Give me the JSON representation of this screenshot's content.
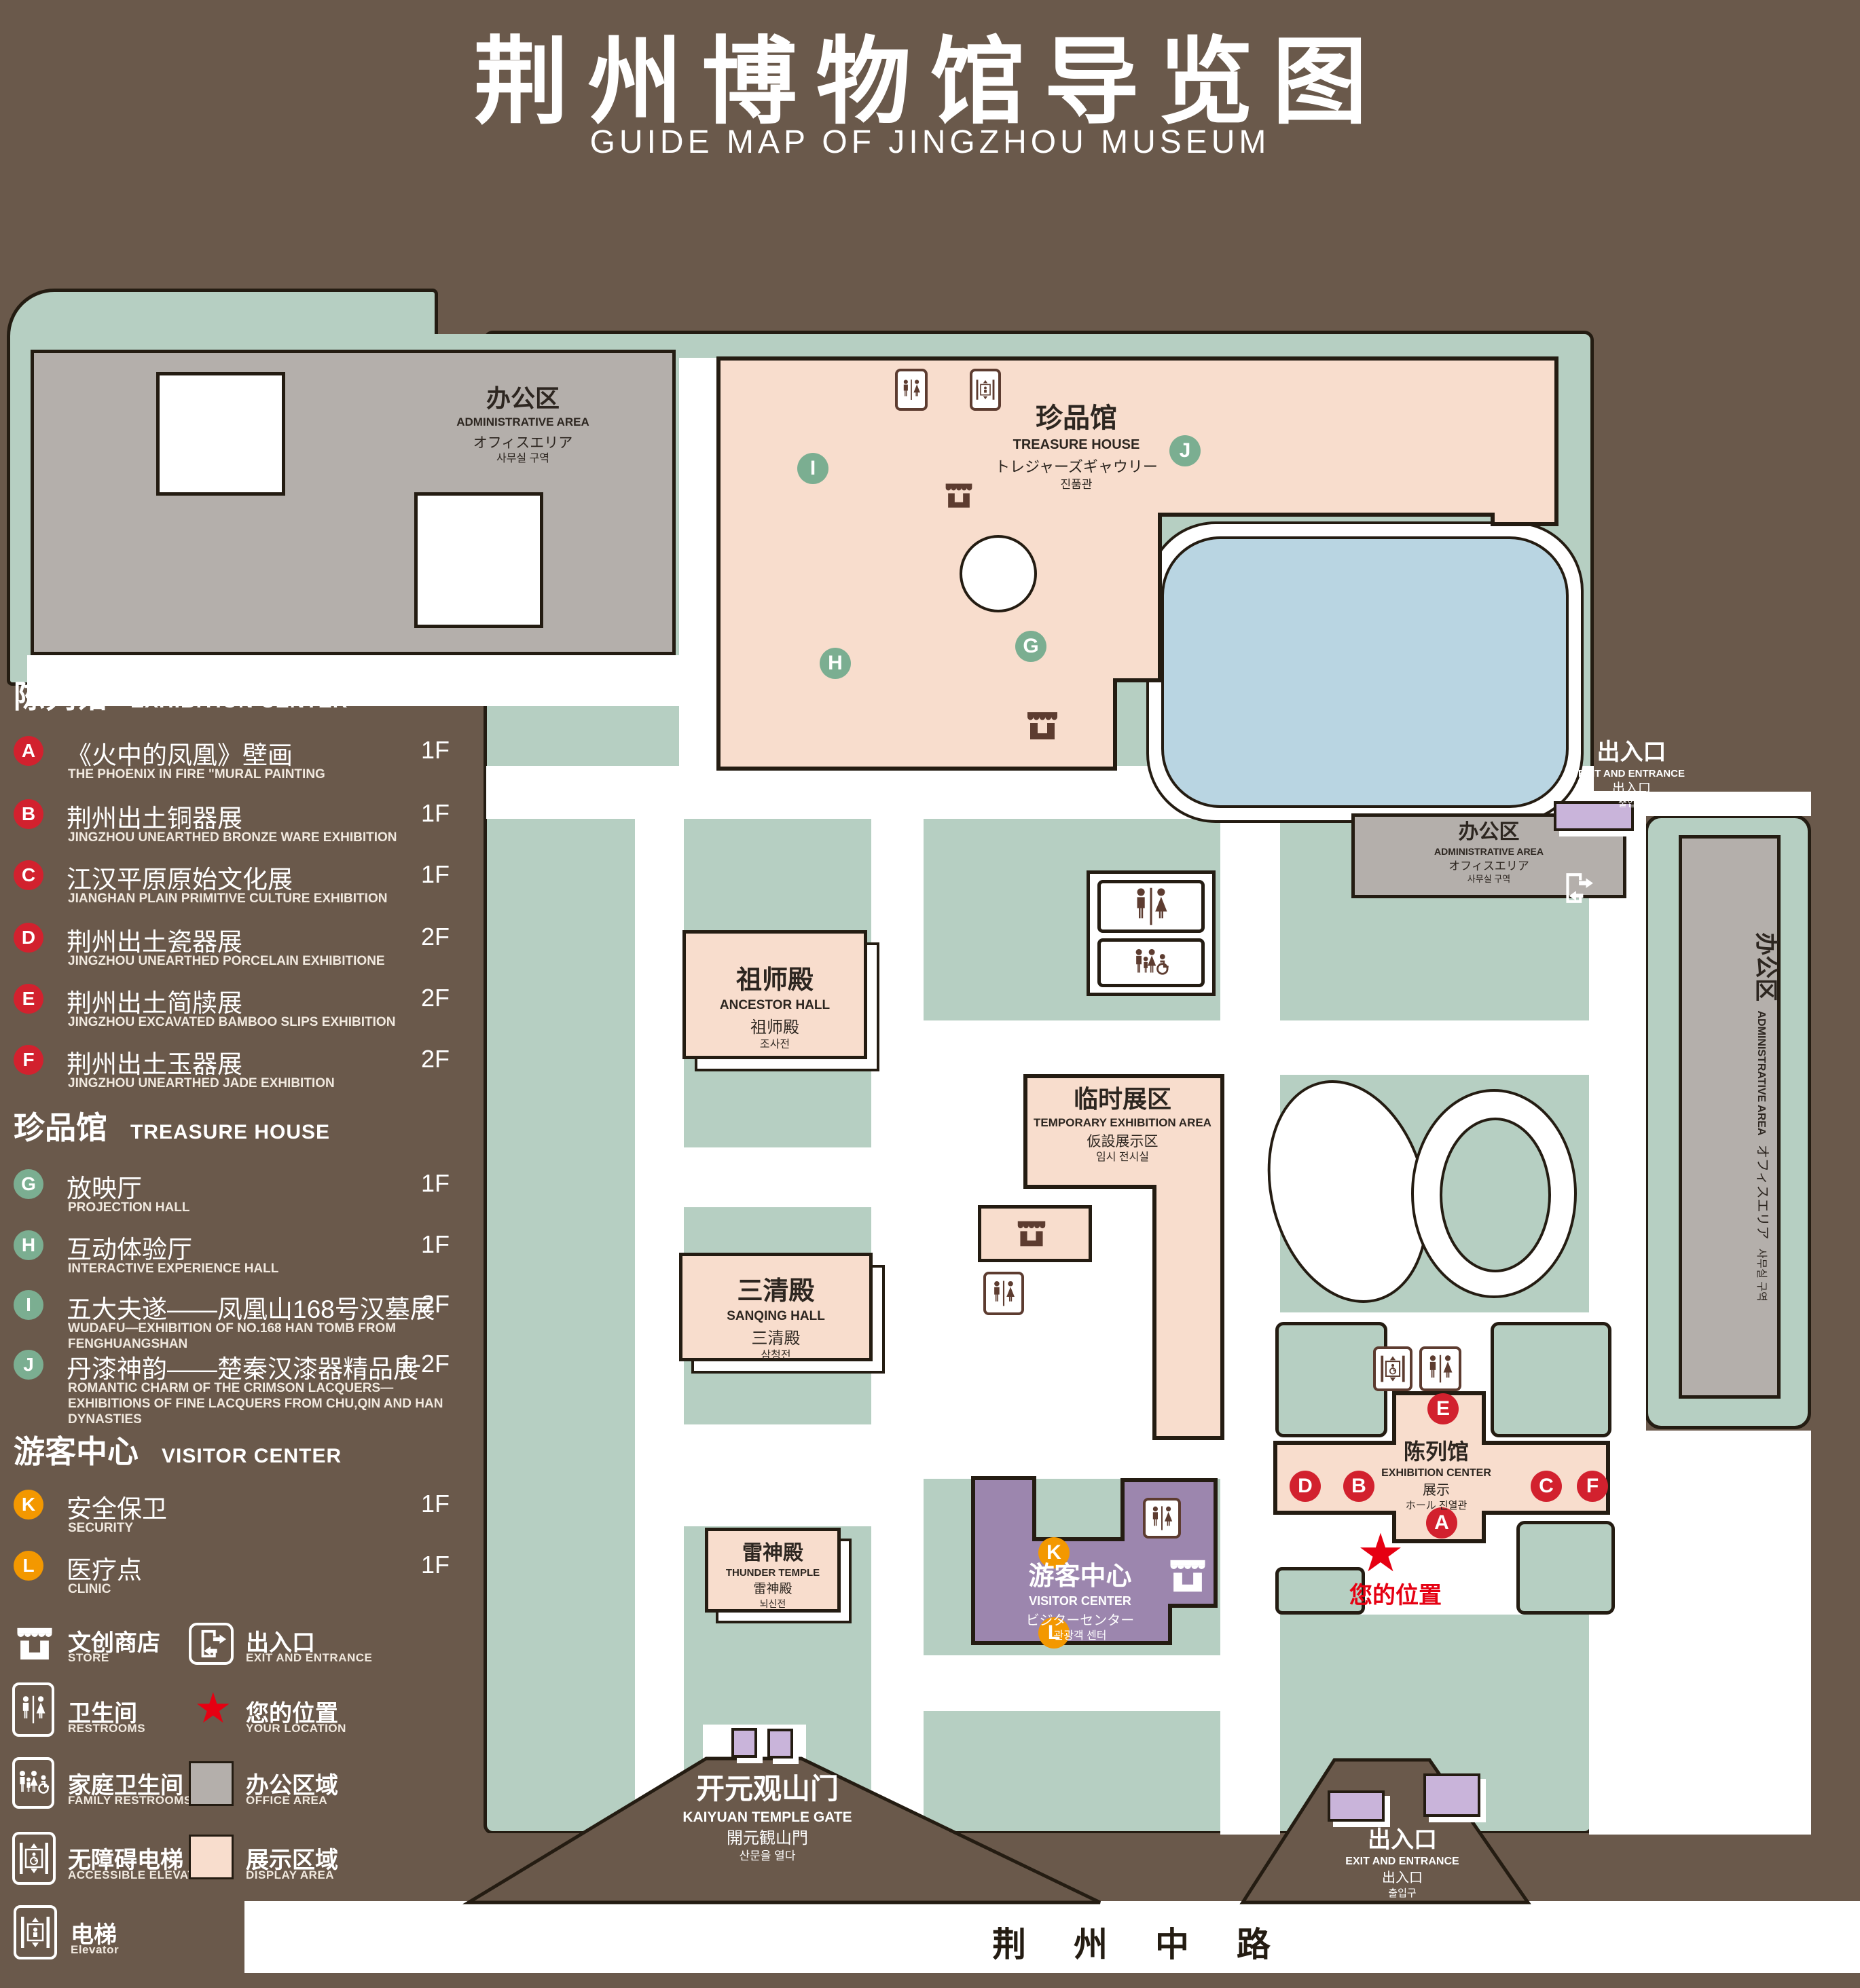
{
  "title": {
    "zh": "荆州博物馆导览图",
    "en": "GUIDE MAP OF JINGZHOU MUSEUM"
  },
  "colors": {
    "background": "#6a594b",
    "lawn": "#b6cfc2",
    "display_area": "#f8ddcd",
    "office_area": "#b4afab",
    "visitor_center": "#9c86ae",
    "gate_block": "#c9b4da",
    "pond": "#b9d5e2",
    "badge_red": "#d2212e",
    "badge_green": "#7bae91",
    "badge_orange": "#f39800",
    "location_red": "#e60012"
  },
  "legend": {
    "sections": [
      {
        "zh": "陈列馆",
        "en": "EXHIBITION CENTER",
        "items": [
          {
            "letter": "A",
            "zh": "《火中的凤凰》壁画",
            "en": "THE PHOENIX IN FIRE \"MURAL PAINTING",
            "floor": "1F"
          },
          {
            "letter": "B",
            "zh": "荆州出土铜器展",
            "en": "JINGZHOU UNEARTHED BRONZE WARE EXHIBITION",
            "floor": "1F"
          },
          {
            "letter": "C",
            "zh": "江汉平原原始文化展",
            "en": "JIANGHAN PLAIN PRIMITIVE CULTURE EXHIBITION",
            "floor": "1F"
          },
          {
            "letter": "D",
            "zh": "荆州出土瓷器展",
            "en": "JINGZHOU UNEARTHED PORCELAIN EXHIBITIONE",
            "floor": "2F"
          },
          {
            "letter": "E",
            "zh": "荆州出土简牍展",
            "en": "JINGZHOU EXCAVATED BAMBOO SLIPS EXHIBITION",
            "floor": "2F"
          },
          {
            "letter": "F",
            "zh": "荆州出土玉器展",
            "en": "JINGZHOU UNEARTHED JADE EXHIBITION",
            "floor": "2F"
          }
        ]
      },
      {
        "zh": "珍品馆",
        "en": "TREASURE HOUSE",
        "items": [
          {
            "letter": "G",
            "zh": "放映厅",
            "en": "PROJECTION HALL",
            "floor": "1F"
          },
          {
            "letter": "H",
            "zh": "互动体验厅",
            "en": "INTERACTIVE EXPERIENCE HALL",
            "floor": "1F"
          },
          {
            "letter": "I",
            "zh": "五大夫遂——凤凰山168号汉墓展",
            "en": "WUDAFU—EXHIBITION OF NO.168 HAN TOMB FROM FENGHUANGSHAN",
            "floor": "2F"
          },
          {
            "letter": "J",
            "zh": "丹漆神韵——楚秦汉漆器精品展",
            "en": "ROMANTIC CHARM OF THE CRIMSON LACQUERS—EXHIBITIONS OF FINE LACQUERS FROM CHU,QIN AND HAN DYNASTIES",
            "floor": "1-2F"
          }
        ]
      },
      {
        "zh": "游客中心",
        "en": "VISITOR CENTER",
        "items": [
          {
            "letter": "K",
            "zh": "安全保卫",
            "en": "SECURITY",
            "floor": "1F"
          },
          {
            "letter": "L",
            "zh": "医疗点",
            "en": "CLINIC",
            "floor": "1F"
          }
        ]
      }
    ],
    "symbols_left": [
      {
        "icon": "store-icon",
        "zh": "文创商店",
        "en": "STORE"
      },
      {
        "icon": "restroom-icon",
        "zh": "卫生间",
        "en": "RESTROOMS"
      },
      {
        "icon": "family-restroom-icon",
        "zh": "家庭卫生间",
        "en": "FAMILY RESTROOMS"
      },
      {
        "icon": "accessible-elevator-icon",
        "zh": "无障碍电梯",
        "en": "ACCESSIBLE ELEVATOR"
      },
      {
        "icon": "elevator-icon",
        "zh": "电梯",
        "en": "Elevator"
      }
    ],
    "symbols_right": [
      {
        "icon": "exit-icon",
        "zh": "出入口",
        "en": "EXIT AND ENTRANCE"
      },
      {
        "icon": "location-star-icon",
        "zh": "您的位置",
        "en": "YOUR LOCATION"
      },
      {
        "icon": "office-swatch",
        "zh": "办公区域",
        "en": "OFFICE AREA"
      },
      {
        "icon": "display-swatch",
        "zh": "展示区域",
        "en": "DISPLAY AREA"
      }
    ]
  },
  "map": {
    "admin_nw": {
      "l1": "办公区",
      "l2": "ADMINISTRATIVE AREA",
      "l3": "オフィスエリア",
      "l4": "사무실 구역"
    },
    "treasure": {
      "l1": "珍品馆",
      "l2": "TREASURE HOUSE",
      "l3": "トレジャーズギャウリー",
      "l4": "진품관"
    },
    "ancestor": {
      "l1": "祖师殿",
      "l2": "ANCESTOR HALL",
      "l3": "祖师殿",
      "l4": "조사전"
    },
    "temporary": {
      "l1": "临时展区",
      "l2": "TEMPORARY EXHIBITION AREA",
      "l3": "仮設展示区",
      "l4": "임시 전시실"
    },
    "sanqing": {
      "l1": "三清殿",
      "l2": "SANQING HALL",
      "l3": "三清殿",
      "l4": "삼청전"
    },
    "thunder": {
      "l1": "雷神殿",
      "l2": "THUNDER TEMPLE",
      "l3": "雷神殿",
      "l4": "뇌신전"
    },
    "visitor": {
      "l1": "游客中心",
      "l2": "VISITOR CENTER",
      "l3": "ビジターセンター",
      "l4": "관광객 센터"
    },
    "exhibition": {
      "l1": "陈列馆",
      "l2": "EXHIBITION CENTER",
      "l3": "展示",
      "l4": "ホール 진열관"
    },
    "admin_e": {
      "l1": "办公区",
      "l2": "ADMINISTRATIVE AREA",
      "l3": "オフィスエリア",
      "l4": "사무실 구역"
    },
    "admin_vert": {
      "l1": "办公区",
      "l2": "ADMINISTRATIVE AREA",
      "l3": "オフィスエリア",
      "l4": "사무실 구역"
    },
    "entrance_e": {
      "l1": "出入口",
      "l2": "EXIT AND ENTRANCE",
      "l3": "出入口",
      "l4": "출입구"
    },
    "gate_kaiyuan": {
      "l1": "开元观山门",
      "l2": "KAIYUAN TEMPLE GATE",
      "l3": "開元観山門",
      "l4": "산문을 열다"
    },
    "gate_se": {
      "l1": "出入口",
      "l2": "EXIT AND ENTRANCE",
      "l3": "出入口",
      "l4": "출입구"
    },
    "your_location": "您的位置",
    "road": "荆 州 中 路",
    "badges": {
      "a": "A",
      "b": "B",
      "c": "C",
      "d": "D",
      "e": "E",
      "f": "F",
      "g": "G",
      "h": "H",
      "i": "I",
      "j": "J",
      "k": "K",
      "l": "L"
    },
    "star_glyph": "★"
  }
}
